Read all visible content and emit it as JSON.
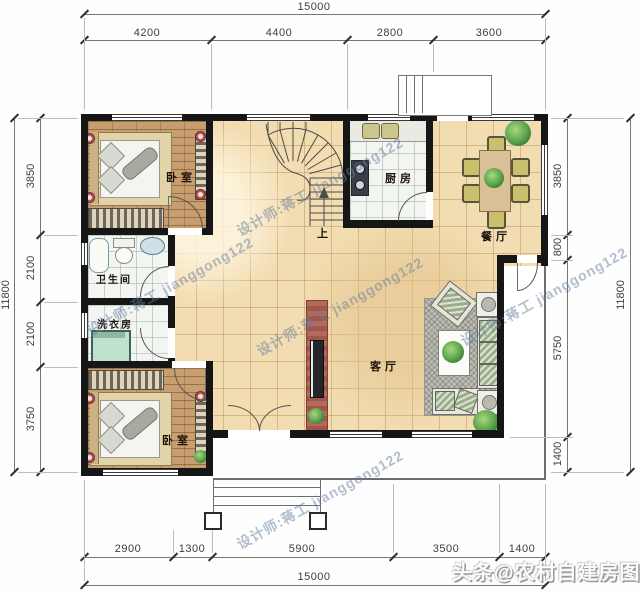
{
  "title": "乡村自建房一层平面图",
  "rooms": {
    "bedroom1": "卧室",
    "bedroom2": "卧室",
    "kitchen": "厨房",
    "dining": "餐厅",
    "bath": "卫生间",
    "laundry": "洗衣房",
    "living": "客厅",
    "stair_up": "上"
  },
  "dims": {
    "top": {
      "overall": "15000",
      "segs": [
        "4200",
        "4400",
        "2800",
        "3600"
      ]
    },
    "bottom": {
      "overall": "15000",
      "segs": [
        "2900",
        "1300",
        "5900",
        "3500",
        "1400"
      ]
    },
    "left": {
      "overall": "11800",
      "segs": [
        "3850",
        "2100",
        "2100",
        "3750"
      ]
    },
    "right": {
      "overall": "11800",
      "segs": [
        "3850",
        "800",
        "5750",
        "1400"
      ]
    }
  },
  "watermark": {
    "text": "设计师:蒋工 jianggong122"
  },
  "footer": {
    "badge": "头条@农村自建房图纸"
  },
  "colors": {
    "wall": "#161616",
    "floor_tile": "#f2ddb2",
    "wood_floor": "#c79e6f",
    "plant_green": "#57a04a",
    "sofa_green": "#9dac8a",
    "watermark_blue": "#647da0"
  }
}
